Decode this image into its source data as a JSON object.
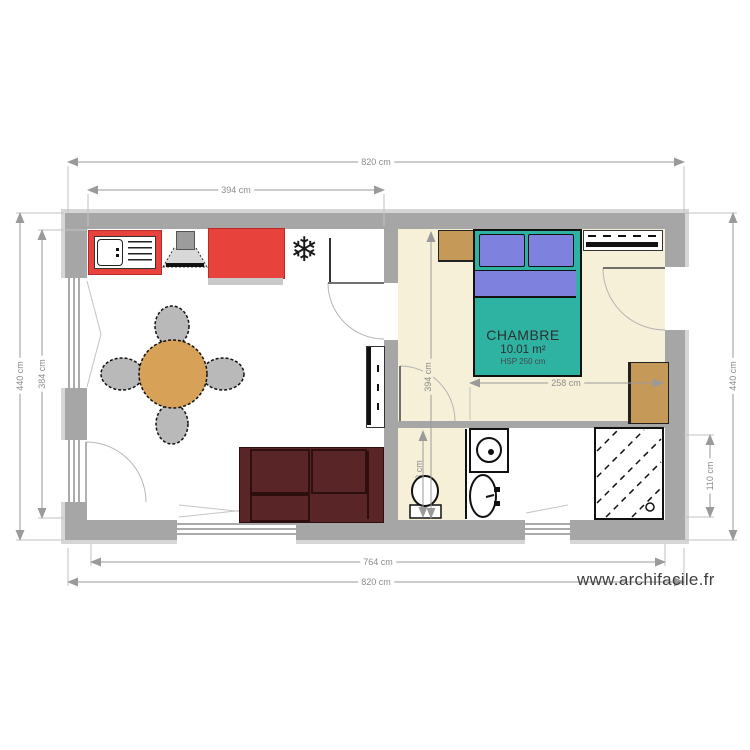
{
  "plan": {
    "room_label": {
      "name": "CHAMBRE",
      "area": "10.01 m²",
      "ceiling_height": "HSP 250 cm"
    },
    "dimensions": {
      "top_outer": "820 cm",
      "top_inner": "394 cm",
      "left_outer": "440 cm",
      "left_inner": "384 cm",
      "right_outer": "440 cm",
      "right_inner": "110 cm",
      "bottom_inner": "764 cm",
      "bottom_outer": "820 cm",
      "bedroom_width": "258 cm",
      "bedroom_height": "394 cm",
      "wc_height": "123 cm"
    },
    "watermark": "www.archifacile.fr",
    "icons": {
      "freezer": "❄"
    },
    "colors": {
      "wall": "#a6a6a6",
      "bedroom_floor": "#f6f0d8",
      "kitchen_red": "#e8423c",
      "table_wood": "#d7a257",
      "sofa": "#5a2526",
      "bed_teal": "#2eb3a3",
      "pillow_violet": "#7e81de",
      "furniture_tan": "#c59a58"
    }
  }
}
